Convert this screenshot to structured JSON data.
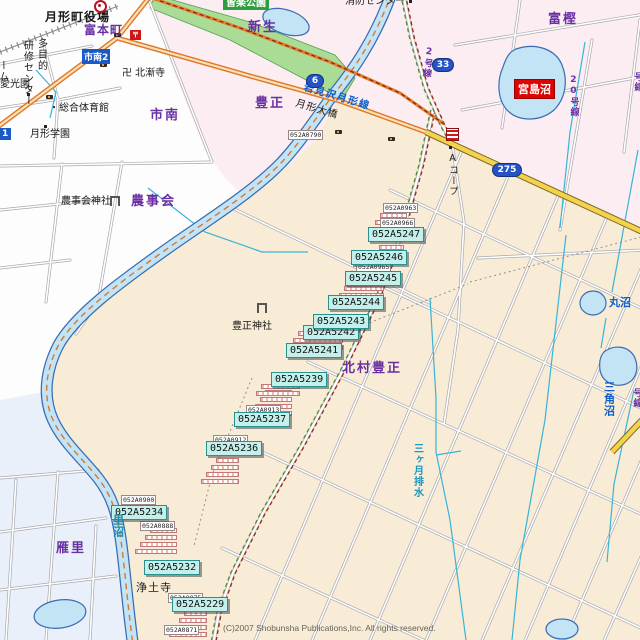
{
  "map": {
    "copyright": "(C)2007 Shobunsha Publications,Inc. All rights reserved.",
    "labels": {
      "shinsei": "新生",
      "toyomasa": "豊正",
      "shinami": "市南",
      "togashi": "富樫",
      "tomimotocho": "富本町",
      "nojikai": "農事会",
      "karisato": "雁里",
      "kitamura_toyomasa": "北村豊正",
      "town_hall": "月形町役場",
      "fire_center": "消防センター",
      "kairaku_park": "皆楽公園",
      "hokuzenji": "卍 北漸寺",
      "tamokuteki": "多目的",
      "kenshu_center": "研修センター",
      "home_partial": "ーム",
      "aikoen": "愛光園",
      "gym": "・総合体育館",
      "gakuen": "月形学園",
      "nojikai_shrine": "農事会神社",
      "toyomasa_shrine": "豊正神社",
      "jodoji": "浄土寺",
      "acoop": "Aコープ",
      "tsukigata_ohashi": "月形大橋",
      "iwamizawa_tsukigata_line": "岩見沢月形線",
      "mikazuki_drain": "三ヶ月排水",
      "marunuma": "丸沼",
      "sankakunuma": "三角沼",
      "satonuma": "里沼",
      "miyajimanuma": "宮島沼",
      "lane2": "2号線",
      "lane20": "20号線",
      "lane_partial_top": "号線",
      "lane_partial_bottom": "号線",
      "shinami2": "市南2",
      "shinami1_partial": "1"
    },
    "shields": {
      "r6": "6",
      "r33": "33",
      "r275": "275"
    },
    "plates": [
      {
        "code": "052A5247"
      },
      {
        "code": "052A5246"
      },
      {
        "code": "052A5245"
      },
      {
        "code": "052A5244"
      },
      {
        "code": "052A5243"
      },
      {
        "code": "052A5242"
      },
      {
        "code": "052A5241"
      },
      {
        "code": "052A5239"
      },
      {
        "code": "052A5237"
      },
      {
        "code": "052A5236"
      },
      {
        "code": "052A5234"
      },
      {
        "code": "052A5232"
      },
      {
        "code": "052A5229"
      }
    ],
    "small_plates": [
      {
        "code": "052A0790"
      },
      {
        "code": "052A0963"
      },
      {
        "code": "052A0966"
      },
      {
        "code": "052A0965"
      },
      {
        "code": "052A0913"
      },
      {
        "code": "052A0912"
      },
      {
        "code": "052A0900"
      },
      {
        "code": "052A0888"
      },
      {
        "code": "052A0875"
      },
      {
        "code": "052A0871"
      }
    ],
    "colors": {
      "urban_cream": "#f8ecd6",
      "rural_pink": "#fbedf2",
      "water": "#c2e4f4",
      "park_green": "#aadc96",
      "main_road_orange": "#e07828",
      "pref_road_yellow": "#f5d24b",
      "area_label_purple": "#6930a2",
      "plate_cyan": "#c4f0ec",
      "lake_label_red": "#dd0404"
    }
  }
}
